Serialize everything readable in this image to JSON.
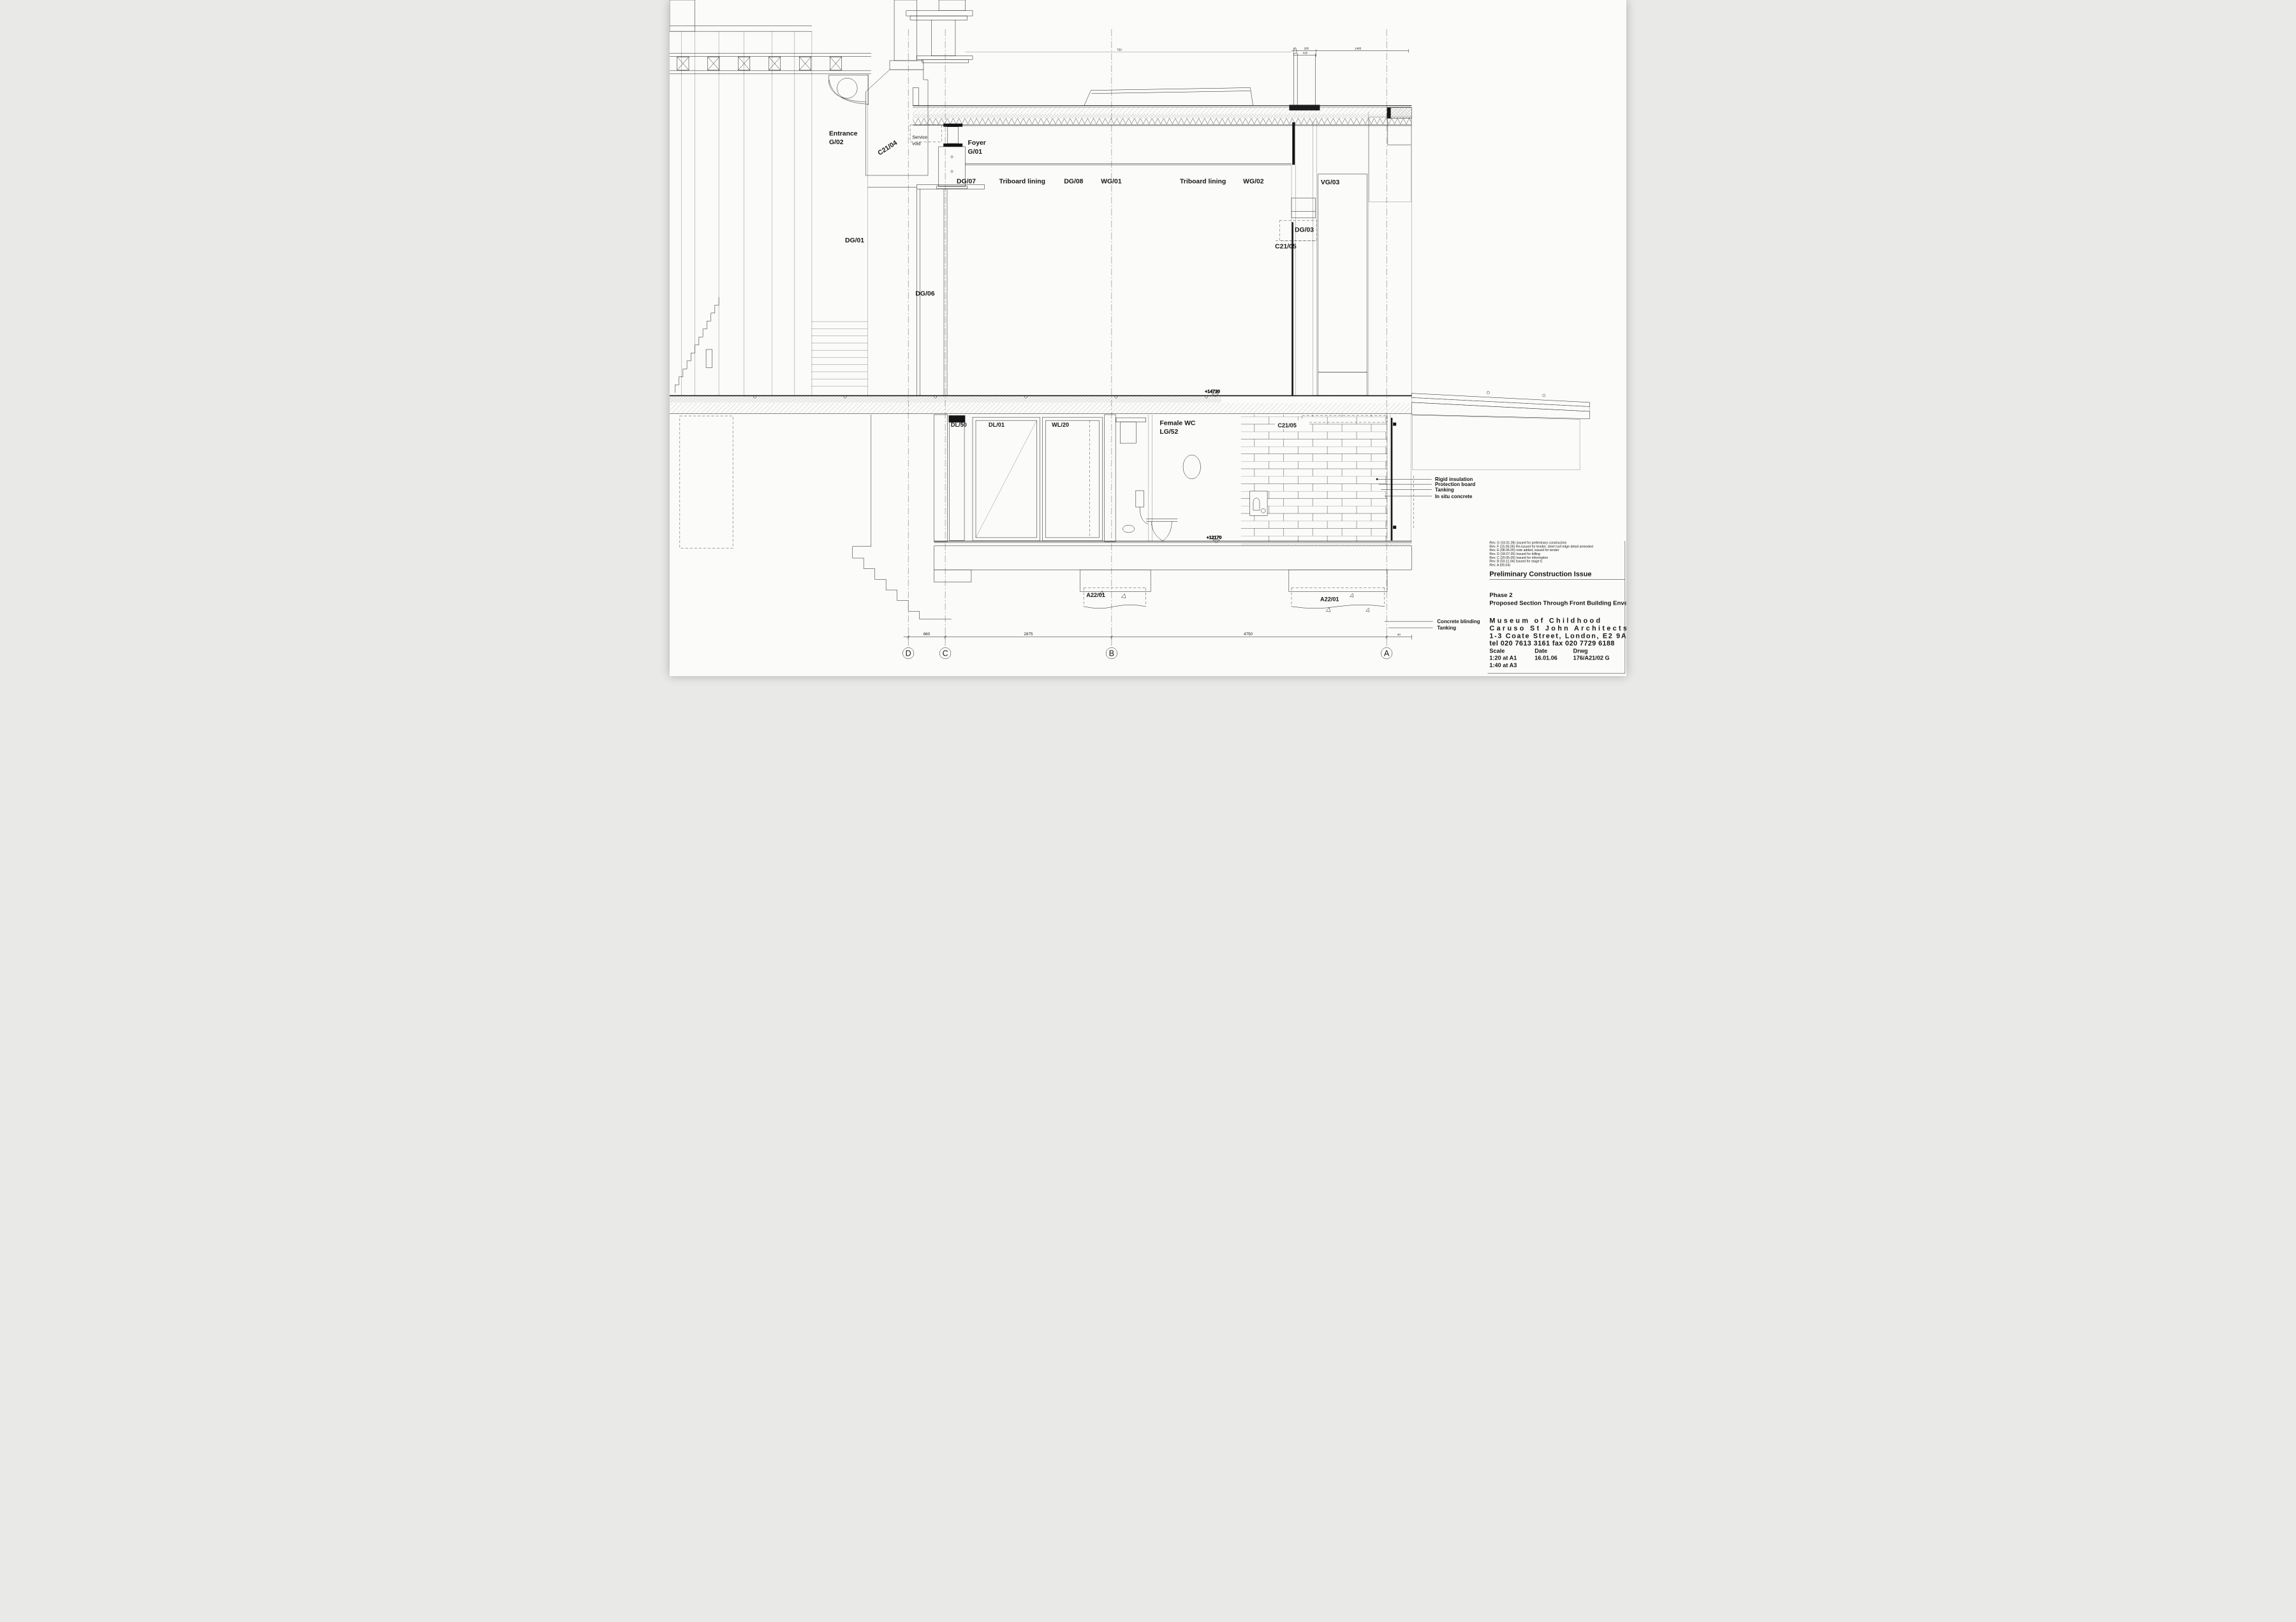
{
  "labels": {
    "entrance_name": "Entrance",
    "entrance_no": "G/02",
    "c21_04": "C21/04",
    "service_1": "Service",
    "service_2": "void",
    "foyer_name": "Foyer",
    "foyer_no": "G/01",
    "dg07": "DG/07",
    "triboard_1": "Triboard lining",
    "dg08": "DG/08",
    "wg01": "WG/01",
    "triboard_2": "Triboard lining",
    "wg02": "WG/02",
    "vg03": "VG/03",
    "dg03": "DG/03",
    "c21_05_upper": "C21/05",
    "dg01": "DG/01",
    "dg06": "DG/06",
    "dl50": "DL/50",
    "dl01": "DL/01",
    "wl20": "WL/20",
    "wc_name": "Female WC",
    "wc_no": "LG/52",
    "c21_05_lower": "C21/05",
    "a22_01_b": "A22/01",
    "a22_01_a": "A22/01"
  },
  "levels": {
    "ground": "+14730",
    "lower_ground": "+12170"
  },
  "annotations": {
    "rigid_insulation": "Rigid insulation",
    "protection_board": "Protection board",
    "tanking_upper": "Tanking",
    "in_situ_concrete": "In situ concrete",
    "concrete_blinding": "Concrete blinding",
    "tanking_lower": "Tanking"
  },
  "dimensions": {
    "d_c": "660",
    "c_b": "2875",
    "b_a": "4750",
    "a_edge": "40",
    "top_40": "40",
    "top_265": "265",
    "top_1485": "1485",
    "top_415": "415",
    "mid_750": "750"
  },
  "grid": {
    "d": "D",
    "c": "C",
    "b": "B",
    "a": "A"
  },
  "titleblock": {
    "revisions": [
      "Rev. G (16.01.06) issued for preliminary construction",
      "Rev. F (15.06.05) Re-issued for tender; steel roof edge detail amended",
      "Rev. E (08.06.05) note added, issued for tender",
      "Rev. D (18.07.05) Issued for billing",
      "Rev. C (20.05.05) Issued for information",
      "Rev. B (03.11.04) Issued for stage E",
      "Rev. A (06.04)"
    ],
    "issue": "Preliminary Construction Issue",
    "phase": "Phase 2",
    "drawing_title": "Proposed Section Through Front Building Envelope",
    "firm_name": "Museum of Childhood",
    "architects": "Caruso St John Architects",
    "address": "1-3 Coate Street, London, E2 9AG",
    "phone": "tel 020 7613 3161  fax 020 7729 6188",
    "scale_label": "Scale",
    "date_label": "Date",
    "drwg_label": "Drwg",
    "scale_1": "1:20 at A1",
    "scale_2": "1:40 at A3",
    "date": "16.01.06",
    "drwg_no": "176/A21/02 G"
  }
}
